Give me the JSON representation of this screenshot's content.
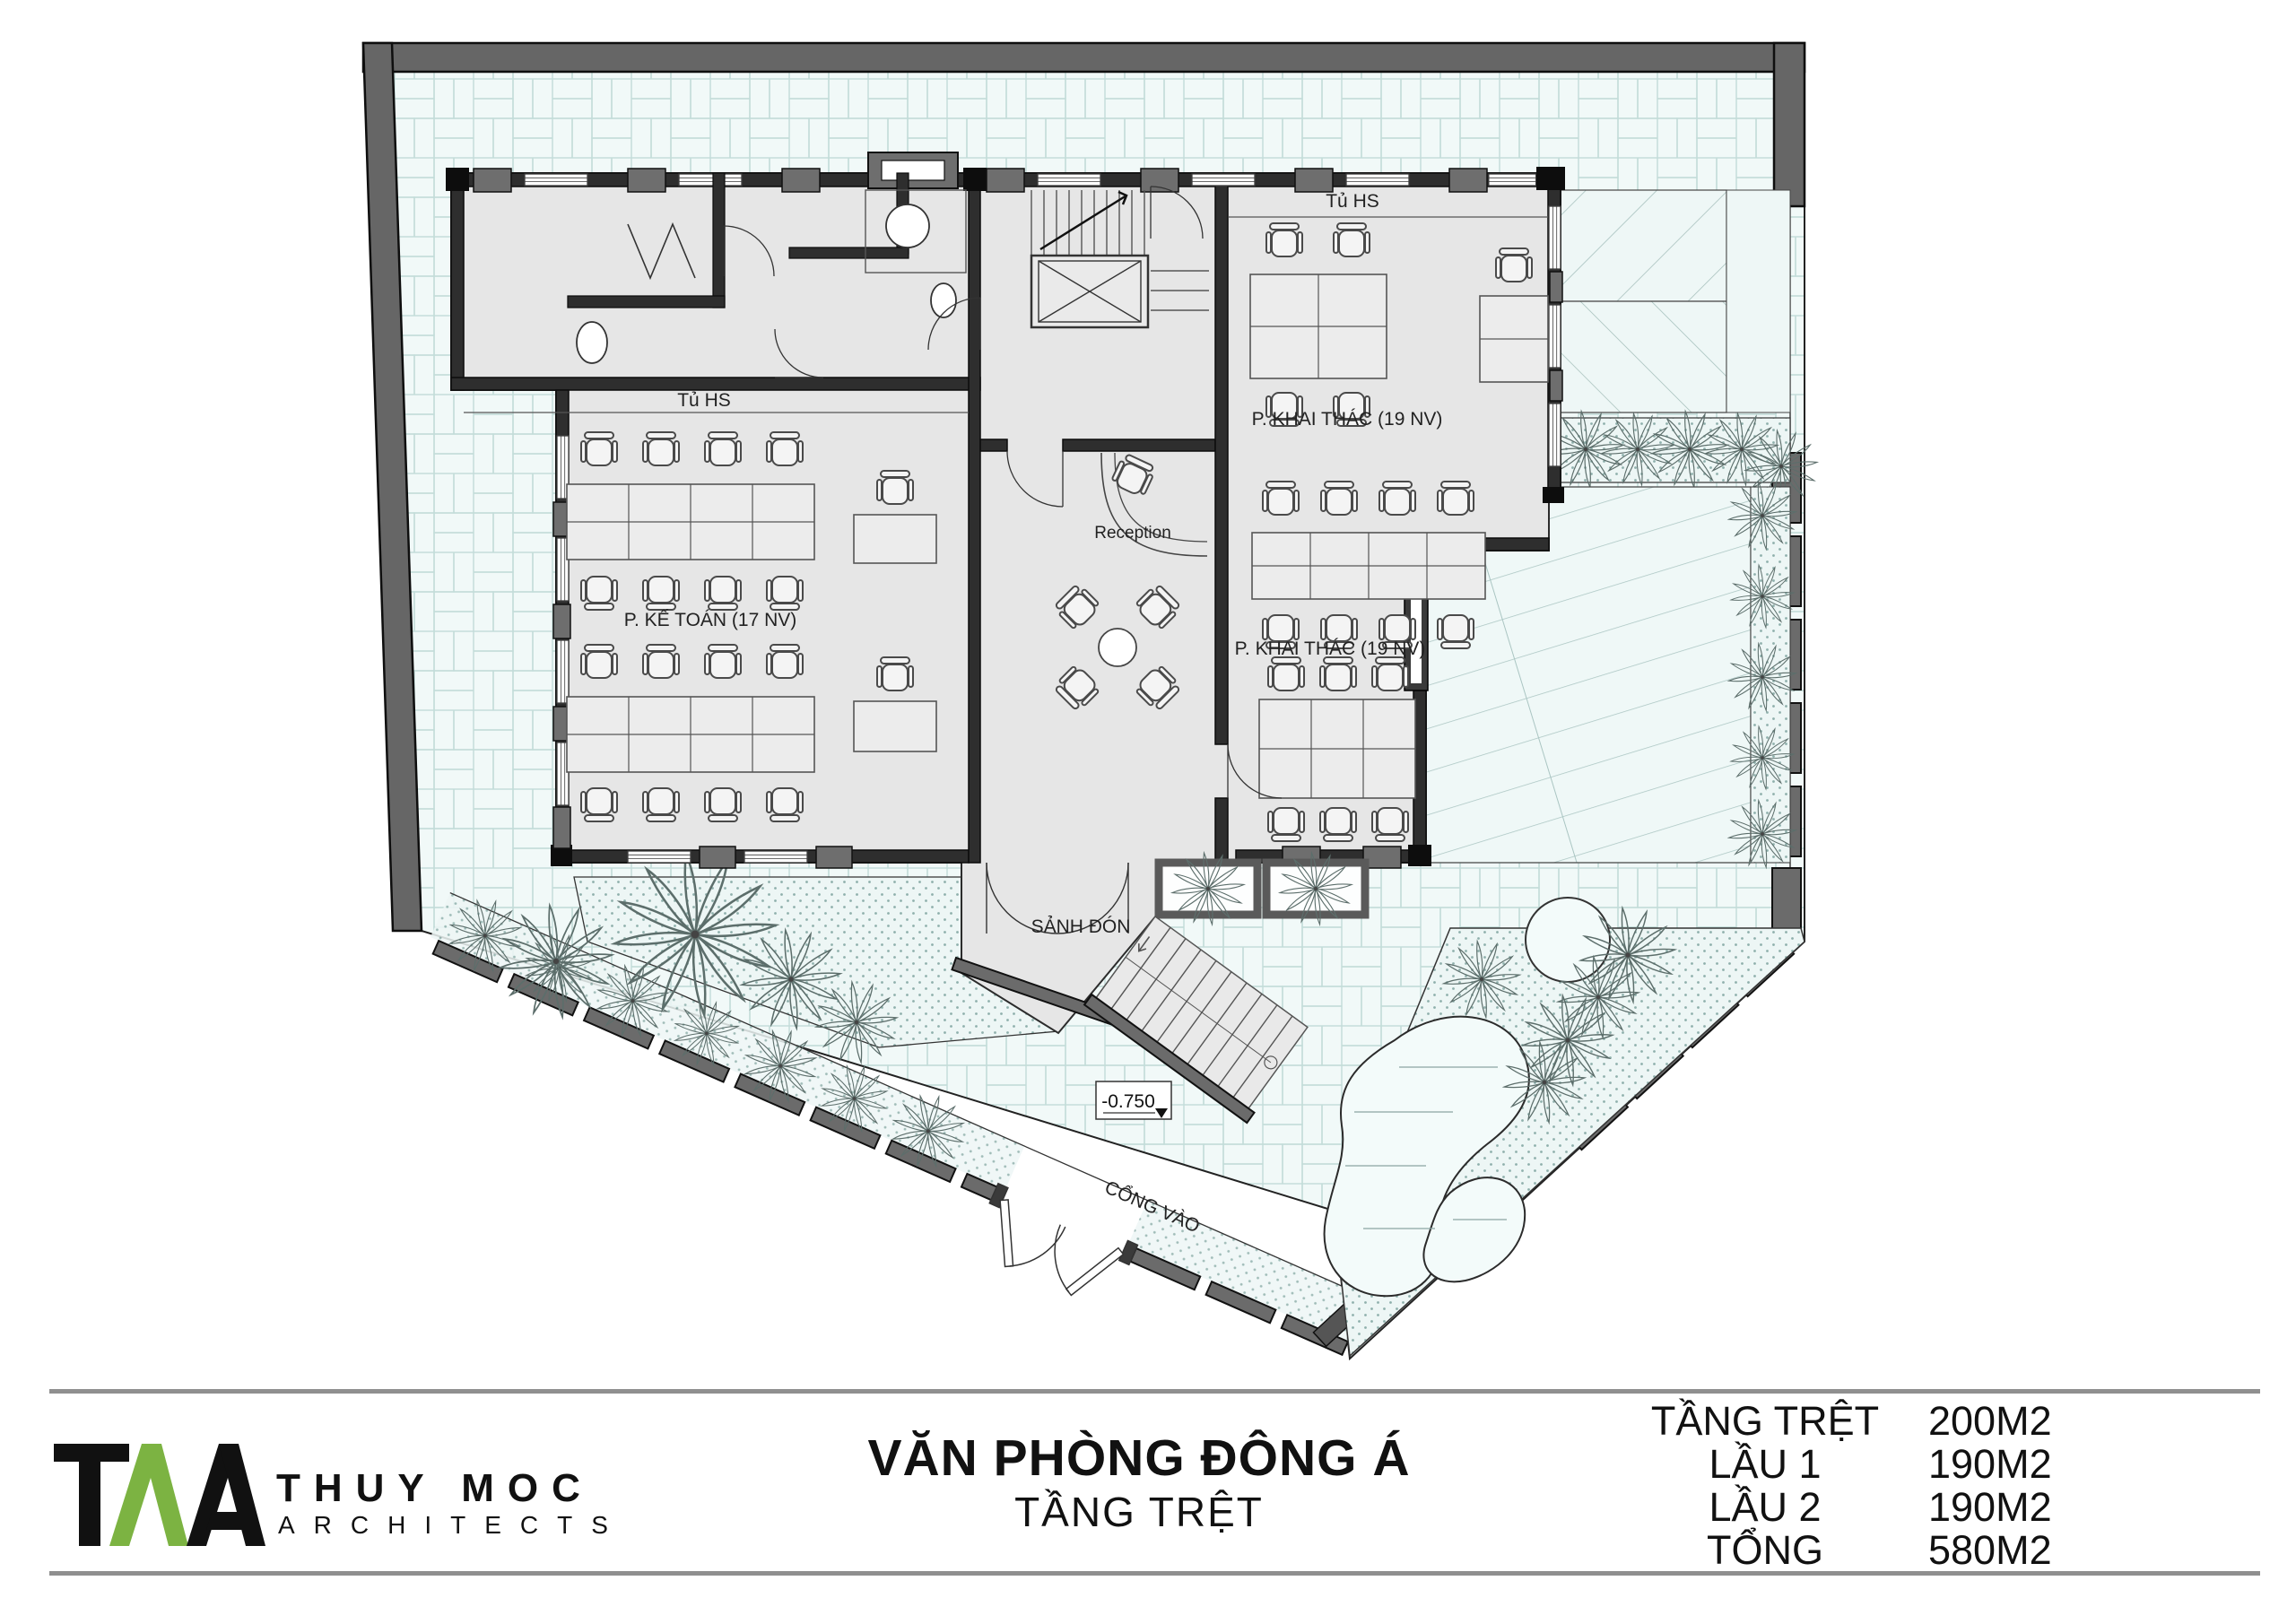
{
  "plan": {
    "labels": {
      "cabinet_left": "Tủ HS",
      "cabinet_right": "Tủ HS",
      "accounting": "P. KẾ TOÁN (17 NV)",
      "operations_upper": "P. KHAI THÁC (19 NV)",
      "operations_lower": "P. KHAI THÁC (19 NV)",
      "reception": "Reception",
      "entry_hall": "SẢNH ĐÓN",
      "gate": "CỔNG VÀO",
      "level": "-0.750"
    },
    "colors": {
      "wall_dark": "#2e2e2e",
      "wall_gray": "#6b6b6b",
      "interior": "#e6e6e6",
      "paving_tint": "#f0f9f8",
      "line": "#444444"
    }
  },
  "footer": {
    "project_title": "VĂN PHÒNG ĐÔNG Á",
    "sheet_title": "TẦNG TRỆT",
    "logo": {
      "firm_name": "THUY MOC",
      "firm_subtitle": "ARCHITECTS",
      "accent_green": "#7cb342"
    }
  },
  "areas": {
    "rows": [
      {
        "label": "TẦNG TRỆT",
        "value": "200M2"
      },
      {
        "label": "LẦU 1",
        "value": "190M2"
      },
      {
        "label": "LẦU 2",
        "value": "190M2"
      },
      {
        "label": "TỔNG",
        "value": "580M2"
      }
    ]
  }
}
